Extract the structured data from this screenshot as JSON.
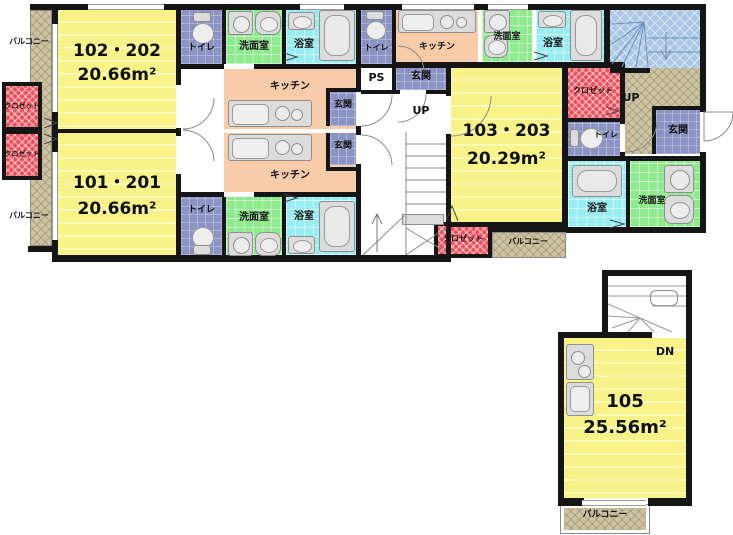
{
  "plan_title": "apartment floor plan",
  "units": [
    {
      "name": "102・202",
      "area": "20.66m²"
    },
    {
      "name": "101・201",
      "area": "20.66m²"
    },
    {
      "name": "103・203",
      "area": "20.29m²"
    },
    {
      "name": "105",
      "area": "25.56m²"
    }
  ],
  "labels": {
    "toilet": "トイレ",
    "washroom": "洗面室",
    "bathroom": "浴室",
    "kitchen": "キッチン",
    "entrance": "玄関",
    "closet": "クロゼット",
    "balcony": "バルコニー",
    "pipe_space": "PS",
    "stairs_up": "UP",
    "stairs_down": "DN"
  },
  "colors": {
    "room_yellow": "#f7f388",
    "kitchen_peach": "#f8cba9",
    "washroom_green": "#8dea8d",
    "bath_cyan": "#96edf2",
    "tile_blue": "#8a93c3",
    "closet_red": "#f3505c",
    "balcony_tan": "#cdc3a1",
    "stairs_blue": "#abc7e6",
    "wall": "#151515"
  }
}
